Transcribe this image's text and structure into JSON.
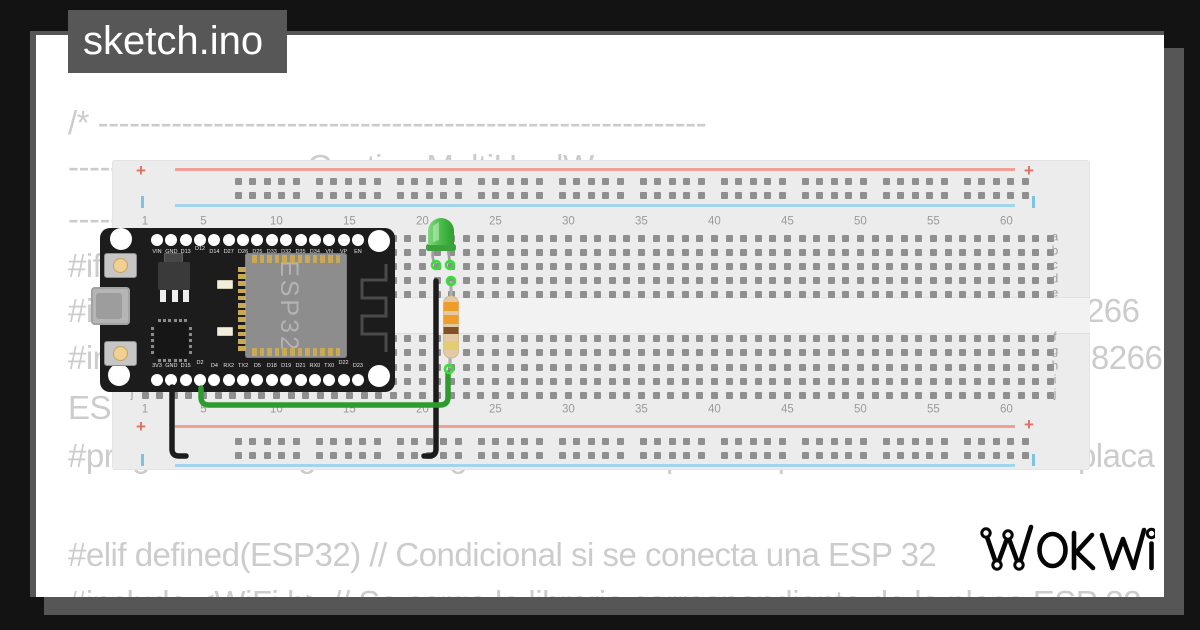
{
  "window": {
    "title": "sketch.ino"
  },
  "code": {
    "lines": [
      "/* ----------------------------------------------------------",
      "---------------------- Gestion MultiHardWare ----------------------",
      "--------------------------------------------------------------",
      "#if defined(ESP8266) // Condicional si se conecta una ESP8266",
      "#include <ESP8266WiFi.h> // Se carga la libreria de la placa para ESP8266",
      "#include <ESP8266WiFiMulti.h> // Se carga la libreria para la placa ESP8266",
      "ESP8266WiFiMulti wifiMulti;",
      "#pragma message \"El codigo se esta compilando para utilizarse con la placa ESP8266\"",
      "",
      "#elif defined(ESP32) // Condicional si se conecta una ESP 32",
      "#include <WiFi.h> // Se carga la libreria correspondiente de la placa ESP 32"
    ]
  },
  "breadboard": {
    "plus": "+",
    "column_numbers": [
      "1",
      "5",
      "10",
      "15",
      "20",
      "25",
      "30",
      "35",
      "40",
      "45",
      "50",
      "55",
      "60"
    ],
    "row_letters": [
      "a",
      "b",
      "c",
      "d",
      "e",
      "f",
      "g",
      "h",
      "i",
      "j"
    ],
    "colors": {
      "body": "#ececec",
      "hole": "#8f8f8f",
      "rail_red": "#f0a096",
      "rail_blue": "#a2d4ec",
      "label": "#9a9a9a"
    }
  },
  "esp32_board": {
    "chip_label": "ESP32",
    "top_pins": [
      "VIN",
      "GND",
      "D13",
      "D12",
      "D14",
      "D27",
      "D26",
      "D25",
      "D33",
      "D32",
      "D35",
      "D34",
      "VN",
      "VP",
      "EN"
    ],
    "bottom_pins": [
      "3V3",
      "GND",
      "D15",
      "D2",
      "D4",
      "RX2",
      "TX2",
      "D5",
      "D18",
      "D19",
      "D21",
      "RX0",
      "TX0",
      "D22",
      "D23"
    ],
    "colors": {
      "pcb": "#1c1c1c",
      "module": "#8d8d8d",
      "pin_gold": "#c9a856"
    }
  },
  "parts": {
    "led": {
      "type": "LED",
      "color": "green"
    },
    "resistor": {
      "type": "resistor",
      "bands": [
        "orange",
        "orange",
        "brown",
        "gold"
      ]
    },
    "wires": [
      {
        "color": "black",
        "from": "GND",
        "to": "bottom-negative-rail"
      },
      {
        "color": "black",
        "from": "led-cathode-column",
        "to": "bottom-negative-rail"
      },
      {
        "color": "green",
        "from": "D2",
        "to": "resistor"
      }
    ]
  },
  "logo": {
    "text": "WOKWI"
  }
}
